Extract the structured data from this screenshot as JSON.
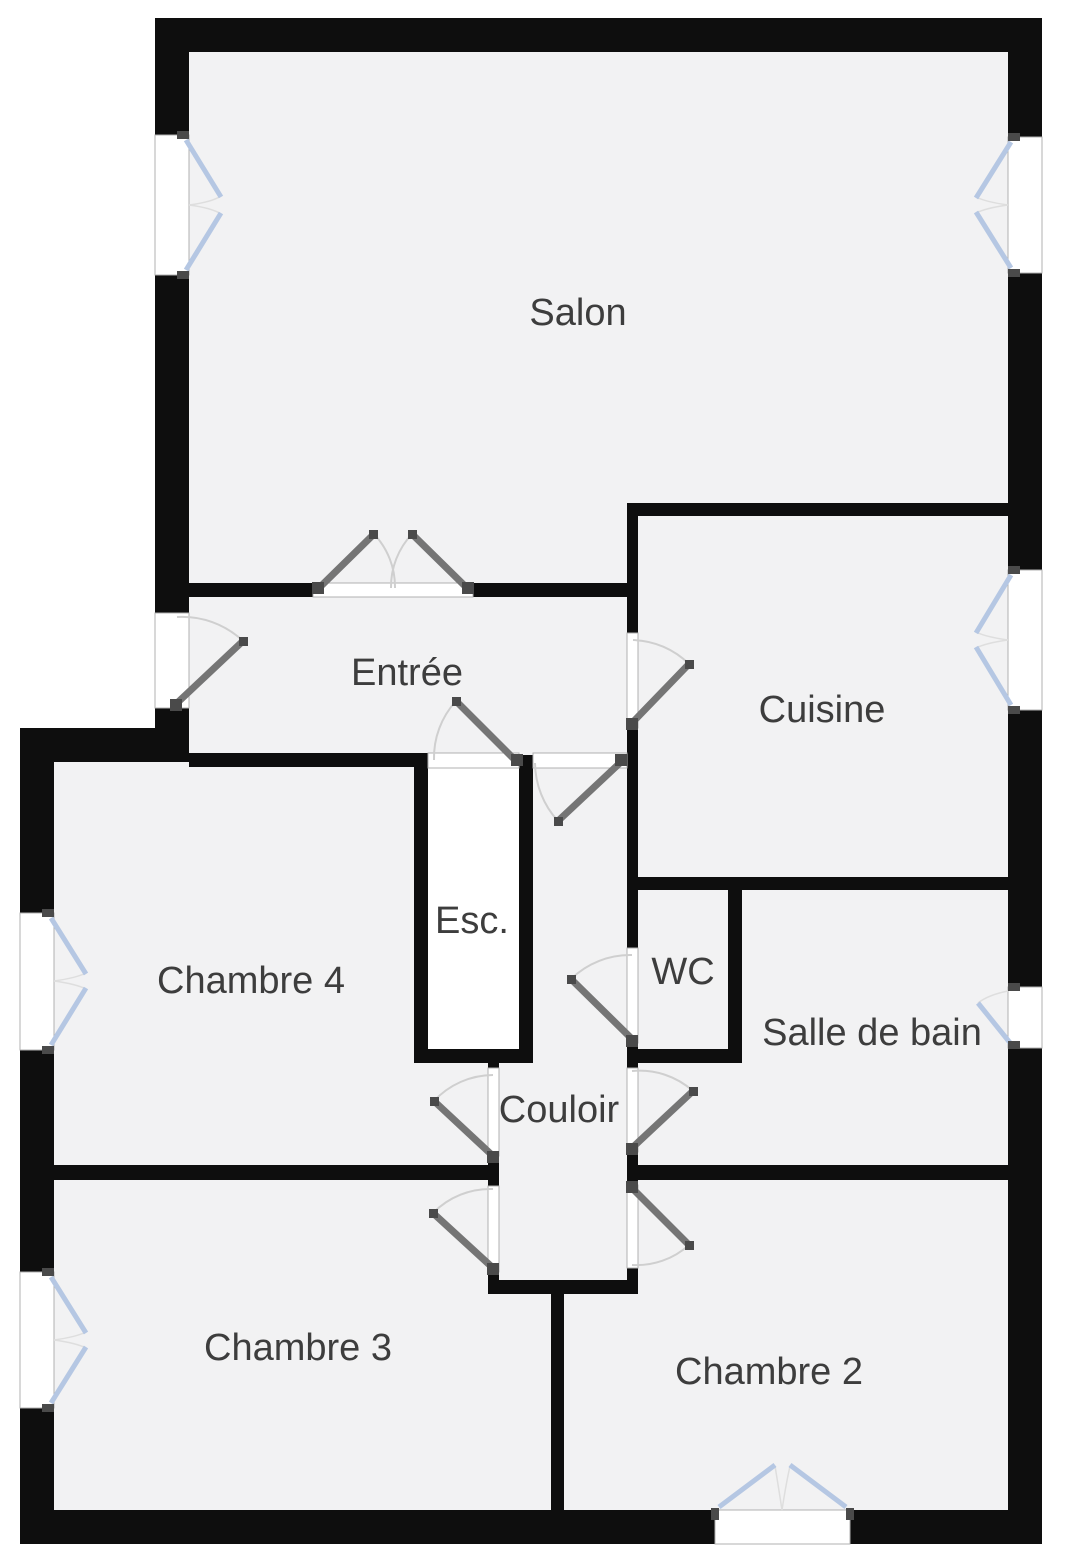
{
  "plan": {
    "type": "apartment-floor-plan",
    "rooms": {
      "salon": {
        "label": "Salon"
      },
      "entree": {
        "label": "Entrée"
      },
      "cuisine": {
        "label": "Cuisine"
      },
      "esc": {
        "label": "Esc."
      },
      "chambre4": {
        "label": "Chambre 4"
      },
      "wc": {
        "label": "WC"
      },
      "sdb": {
        "label": "Salle de bain"
      },
      "couloir": {
        "label": "Couloir"
      },
      "chambre3": {
        "label": "Chambre 3"
      },
      "chambre2": {
        "label": "Chambre 2"
      }
    }
  },
  "colors": {
    "background": "#ffffff",
    "wall": "#0e0e0e",
    "floor": "#f2f2f3",
    "stairwell": "#ffffff",
    "door": "#757575",
    "hinge": "#4a4a4a",
    "window": "#b5c7e3",
    "arc": "#cfcfcf",
    "opening_frame": "#b0b0b0",
    "label": "#3d3d3d"
  }
}
